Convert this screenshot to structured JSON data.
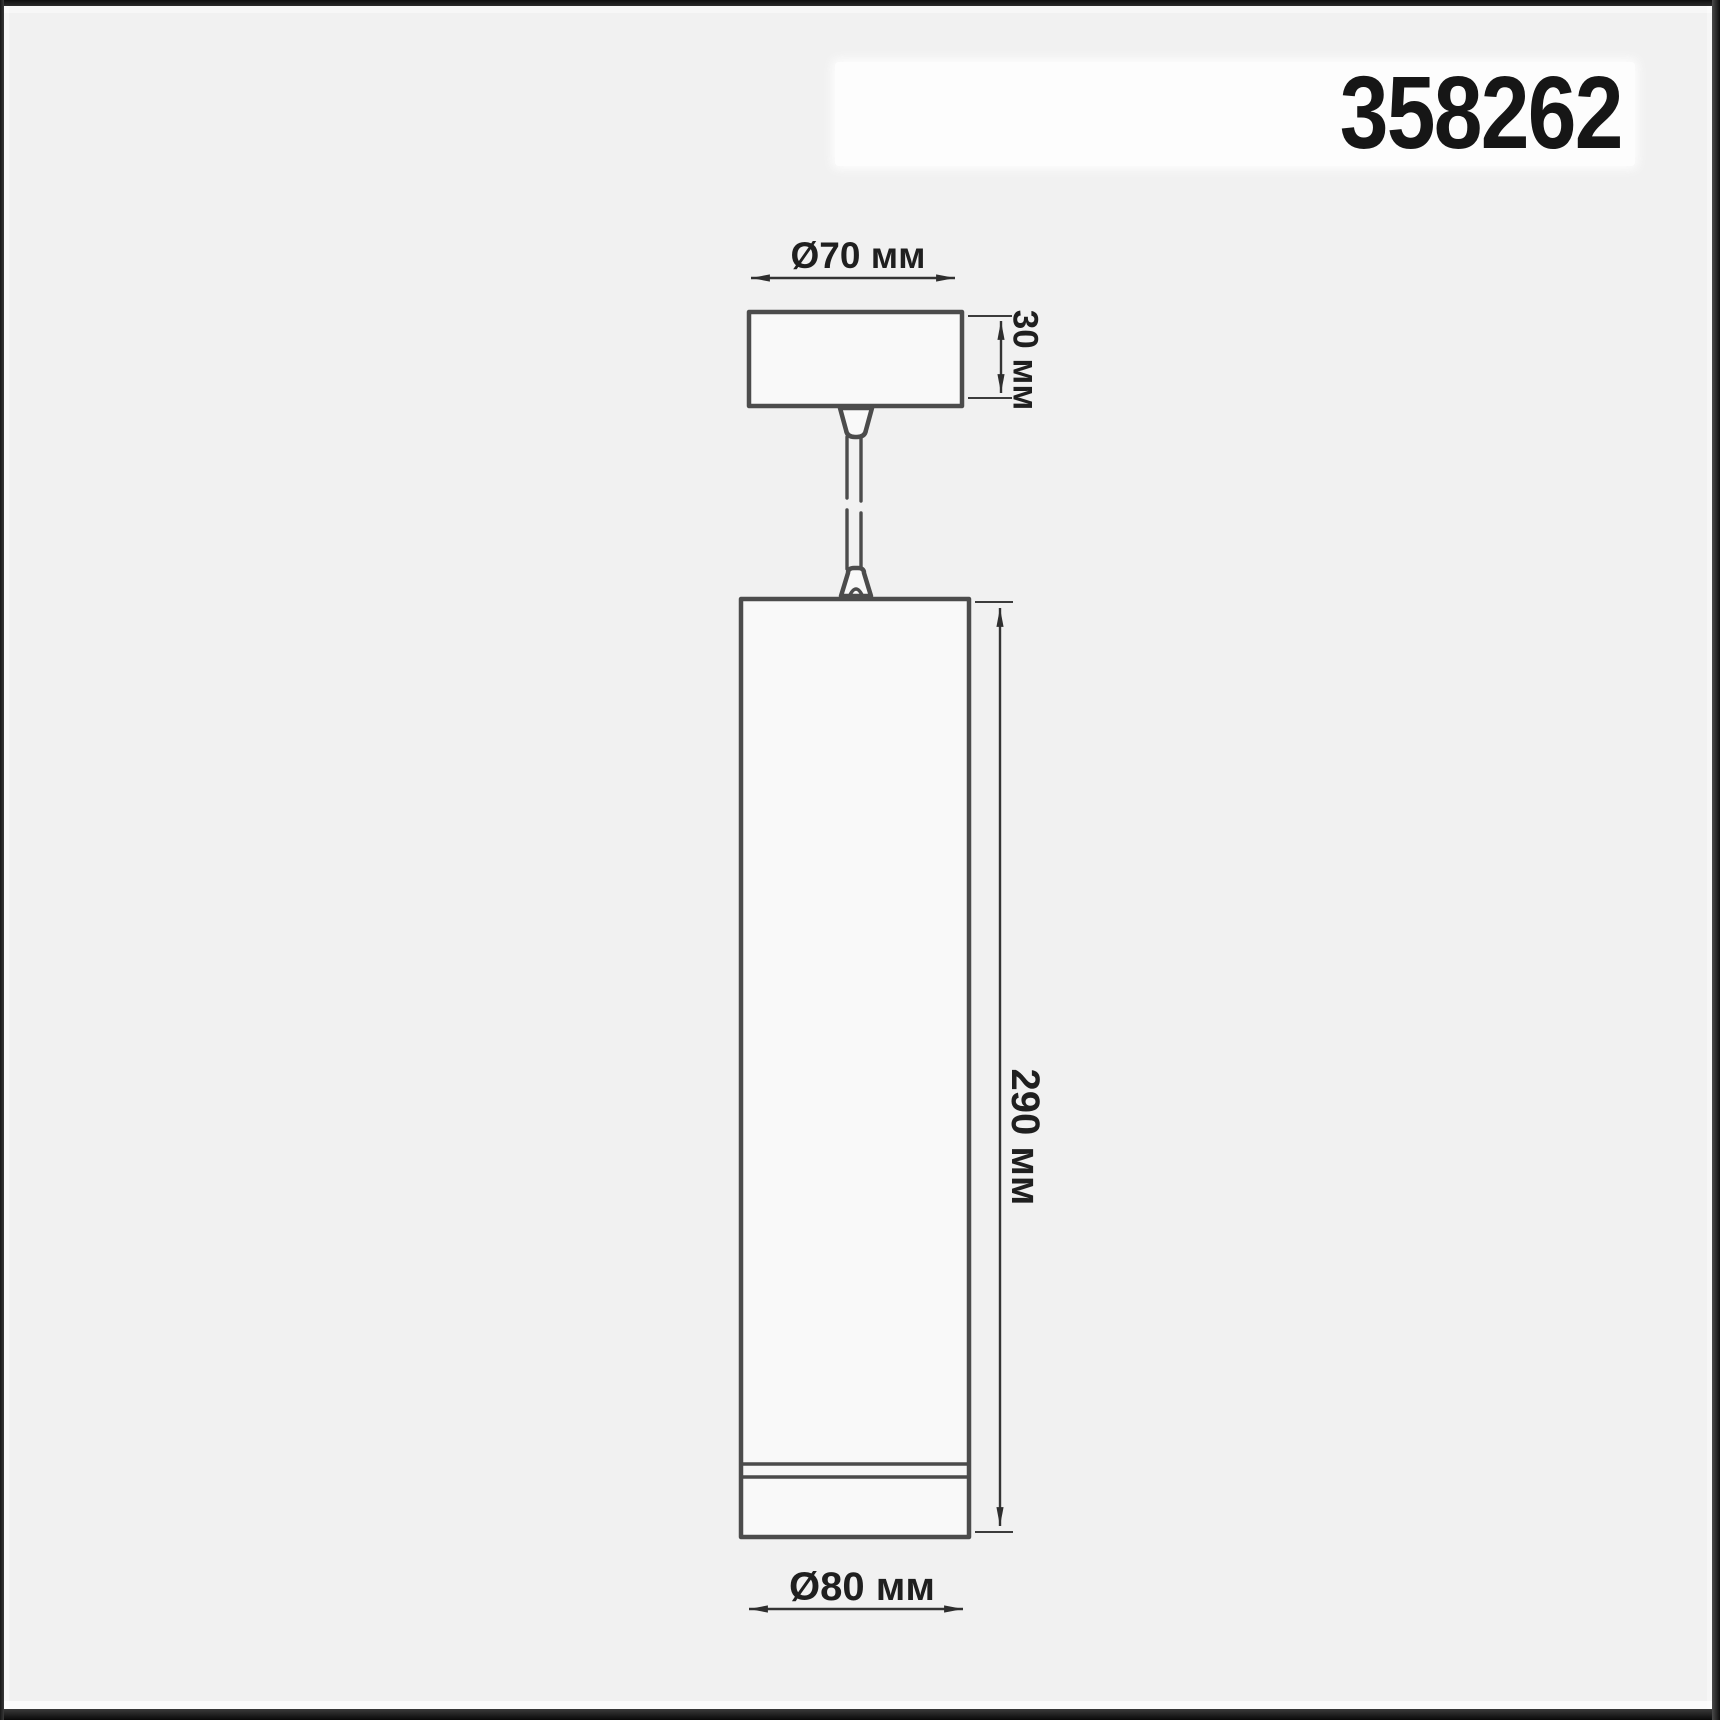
{
  "product": {
    "code": "358262"
  },
  "diagram": {
    "type": "technical-dimension-drawing",
    "subject": "pendant-cylinder-luminaire",
    "unit": "мм",
    "labels": {
      "canopy_diameter": "Ø70 мм",
      "canopy_height": "30 мм",
      "body_height": "290 мм",
      "body_diameter": "Ø80 мм"
    },
    "dimensions_mm": {
      "canopy_diameter": 70,
      "canopy_height": 30,
      "body_height": 290,
      "body_diameter": 80
    },
    "colors": {
      "background": "#f1f1f1",
      "outline": "#4c4c4c",
      "dimension_line": "#343434",
      "text": "#1f1f1f",
      "backdrop": "#fdfdfd",
      "frame": "#141414"
    }
  }
}
